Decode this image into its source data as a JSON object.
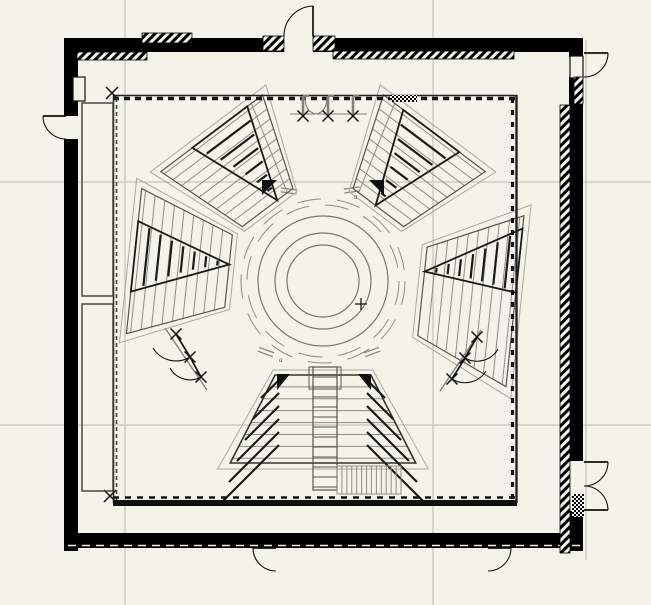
{
  "canvas": {
    "w": 651,
    "h": 605,
    "bg": "#f4f3ea"
  },
  "colors": {
    "grid": "#cdccc4",
    "wall": "#000000",
    "dark": "#1a1a1a",
    "mid": "#55554e",
    "row": "#8d8d86",
    "faint": "#a8a8a0",
    "post": "#808078",
    "white": "#f4f3ea"
  },
  "grid": {
    "vertical": [
      125,
      433
    ],
    "horizontal": [
      182,
      425
    ],
    "ref_line": {
      "x": 586,
      "y1": 40,
      "y2": 560
    }
  },
  "walls": [
    {
      "name": "wall-top-left",
      "r": [
        66,
        38,
        218,
        14
      ]
    },
    {
      "name": "wall-top-right",
      "r": [
        313,
        38,
        270,
        14
      ]
    },
    {
      "name": "wall-left-upper",
      "r": [
        64,
        38,
        14,
        78
      ]
    },
    {
      "name": "wall-left-lower",
      "r": [
        64,
        139,
        14,
        412
      ]
    },
    {
      "name": "wall-right-top",
      "r": [
        569,
        38,
        14,
        19
      ]
    },
    {
      "name": "wall-right-main",
      "r": [
        569,
        77,
        14,
        384
      ]
    },
    {
      "name": "wall-right-bottom",
      "r": [
        569,
        511,
        14,
        40
      ]
    },
    {
      "name": "wall-bottom",
      "r": [
        66,
        533,
        517,
        15
      ]
    }
  ],
  "wall_bottom_dash": {
    "y": 545.5,
    "x1": 68,
    "x2": 581
  },
  "niches": [
    [
      73,
      77,
      12,
      24
    ],
    [
      570,
      56,
      13,
      22
    ]
  ],
  "hatches": [
    [
      142,
      33,
      50,
      10
    ],
    [
      77,
      52,
      70,
      8
    ],
    [
      263,
      36,
      21,
      15
    ],
    [
      313,
      36,
      22,
      15
    ],
    [
      333,
      51,
      181,
      8
    ],
    [
      560,
      105,
      10,
      448
    ],
    [
      574,
      77,
      9,
      27
    ]
  ],
  "checkers": [
    [
      390,
      95,
      27,
      7
    ],
    [
      572,
      494,
      12,
      23
    ]
  ],
  "inner_hall": {
    "x1": 113,
    "y1": 95,
    "x2": 517,
    "y2": 503,
    "bottom_band": [
      113,
      500,
      404,
      6
    ],
    "x_marks": [
      [
        112,
        93
      ],
      [
        110,
        496
      ]
    ]
  },
  "shafts": [
    [
      82,
      103,
      31,
      193
    ],
    [
      82,
      304,
      31,
      187
    ]
  ],
  "doors": [
    {
      "name": "door-top",
      "hinge": [
        313,
        36
      ],
      "tip": [
        313,
        6
      ],
      "end": [
        284,
        36
      ]
    },
    {
      "name": "door-left",
      "hinge": [
        66,
        116
      ],
      "tip": [
        43,
        116
      ],
      "end": [
        66,
        139
      ]
    },
    {
      "name": "door-top-right",
      "hinge": [
        584,
        53
      ],
      "tip": [
        608,
        53
      ],
      "end": [
        584,
        77
      ]
    },
    {
      "name": "door-right-upper",
      "hinge": [
        584,
        462
      ],
      "tip": [
        608,
        462
      ],
      "end": [
        584,
        486
      ]
    },
    {
      "name": "door-right-lower",
      "hinge": [
        584,
        510
      ],
      "tip": [
        608,
        510
      ],
      "end": [
        584,
        486
      ]
    },
    {
      "name": "door-bottom-1",
      "hinge": [
        276,
        548
      ],
      "tip": [
        253,
        548
      ],
      "end": [
        276,
        571
      ]
    },
    {
      "name": "door-bottom-2",
      "hinge": [
        488,
        548
      ],
      "tip": [
        511,
        548
      ],
      "end": [
        488,
        571
      ]
    }
  ],
  "arena": {
    "cx": 323,
    "cy": 281,
    "circle_radii": [
      65,
      48,
      36
    ],
    "rail_radii": [
      76,
      82
    ],
    "cross": [
      361,
      304
    ],
    "rail_ticks": [
      {
        "x": 266,
        "y": 352,
        "rot": 20
      },
      {
        "x": 372,
        "y": 352,
        "rot": -20
      },
      {
        "x": 289,
        "y": 191,
        "rot": 8
      },
      {
        "x": 352,
        "y": 190,
        "rot": -8
      }
    ]
  },
  "wedges": [
    {
      "name": "bottom",
      "th": 90,
      "alpha": 27,
      "r1": 94,
      "r2": 182,
      "rows": 7,
      "stairs": [],
      "dark_edges": true,
      "diag_steps": [
        {
          "x": 279,
          "dir": -1,
          "y0": 380,
          "dy": 13,
          "len0": 18,
          "dlen": 8,
          "n": 6
        },
        {
          "x": 367,
          "dir": 1,
          "y0": 380,
          "dy": 13,
          "len0": 18,
          "dlen": 8,
          "n": 6
        }
      ]
    },
    {
      "name": "left",
      "th": 186,
      "alpha": 21,
      "r1": 95,
      "r2": 190,
      "rows": 9,
      "stairs": [
        {
          "fa": 0.18,
          "f1": 0.55,
          "f2": -0.42,
          "n": 7
        }
      ]
    },
    {
      "name": "right",
      "th": 6,
      "alpha": 24,
      "r1": 100,
      "r2": 193,
      "rows": 9,
      "stairs": [
        {
          "fa": -0.45,
          "f1": -0.85,
          "f2": -0.1,
          "n": 7
        }
      ]
    },
    {
      "name": "top-left",
      "th": 233,
      "alpha": 19,
      "r1": 92,
      "r2": 185,
      "rows": 9,
      "aisles": [
        0.78
      ],
      "stairs": [
        {
          "fa": 0.38,
          "f1": -0.38,
          "f2": 0.7,
          "n": 6
        }
      ]
    },
    {
      "name": "top-right",
      "th": 307,
      "alpha": 19,
      "r1": 92,
      "r2": 185,
      "rows": 9,
      "aisles": [
        -0.78
      ],
      "stairs": [
        {
          "fa": -0.11,
          "f1": -0.61,
          "f2": 0.49,
          "n": 6
        }
      ]
    }
  ],
  "central_stair": {
    "x": 313,
    "w": 24,
    "y1": 367,
    "y2": 490,
    "tread_step": 10,
    "head_box": [
      309,
      367,
      32,
      22
    ]
  },
  "hatch_strip": {
    "x": 337,
    "y": 466,
    "w": 64,
    "h": 28,
    "lines": 13
  },
  "corner_triangles": [
    [
      [
        277,
        374
      ],
      [
        290,
        374
      ],
      [
        277,
        390
      ]
    ],
    [
      [
        371,
        374
      ],
      [
        358,
        374
      ],
      [
        371,
        390
      ]
    ],
    [
      [
        262,
        195
      ],
      [
        262,
        180
      ],
      [
        277,
        180
      ]
    ],
    [
      [
        384,
        195
      ],
      [
        384,
        180
      ],
      [
        369,
        180
      ]
    ]
  ],
  "gates_top": {
    "posts": [
      303,
      328,
      353
    ],
    "post_y1": 96,
    "post_y2": 115,
    "line": {
      "x1": 290,
      "x2": 367,
      "y": 114
    },
    "x_marks": [
      [
        303,
        116
      ],
      [
        328,
        116
      ],
      [
        353,
        116
      ]
    ],
    "arcs": [
      "M305,97 Q305,112 316,114",
      "M327,97 Q327,112 316,114"
    ]
  },
  "gates_diagonal": [
    {
      "name": "vomitory-left",
      "line": [
        165,
        328,
        207,
        390
      ],
      "x_marks": [
        [
          176,
          334
        ],
        [
          190,
          357
        ],
        [
          201,
          377
        ]
      ],
      "doors": [
        {
          "hinge": [
            176,
            334
          ],
          "tip": [
            190,
            357
          ],
          "end": [
            153,
            348
          ]
        },
        {
          "hinge": [
            190,
            357
          ],
          "tip": [
            201,
            377
          ],
          "end": [
            170,
            368
          ]
        }
      ]
    },
    {
      "name": "vomitory-right",
      "line": [
        481,
        330,
        440,
        391
      ],
      "x_marks": [
        [
          477,
          337
        ],
        [
          465,
          358
        ],
        [
          452,
          379
        ]
      ],
      "doors": [
        {
          "hinge": [
            477,
            337
          ],
          "tip": [
            465,
            358
          ],
          "end": [
            498,
            349
          ]
        },
        {
          "hinge": [
            465,
            358
          ],
          "tip": [
            452,
            379
          ],
          "end": [
            486,
            371
          ]
        }
      ]
    }
  ],
  "labels": [
    {
      "t": "a",
      "x": 279,
      "y": 362
    },
    {
      "t": "a",
      "x": 354,
      "y": 199
    }
  ]
}
